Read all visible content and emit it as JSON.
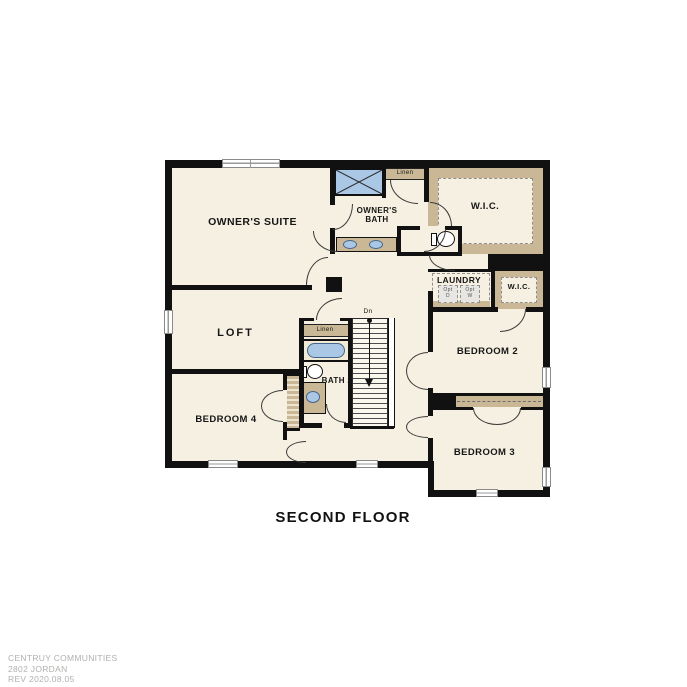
{
  "title": "SECOND FLOOR",
  "footer": {
    "line1": "CENTRUY COMMUNITIES",
    "line2": "2802 JORDAN",
    "line3": "REV 2020.08.05"
  },
  "rooms": {
    "owners_suite": "OWNER'S SUITE",
    "owners_bath": "OWNER'S BATH",
    "loft": "LOFT",
    "bedroom2": "BEDROOM 2",
    "bedroom3": "BEDROOM 3",
    "bedroom4": "BEDROOM 4",
    "bath2": "BATH 2",
    "laundry": "LAUNDRY",
    "wic_large": "W.I.C.",
    "wic_small": "W.I.C.",
    "linen_upper": "Linen",
    "linen_hall": "Linen",
    "opt_dryer": "Opt D",
    "opt_washer": "Opt W",
    "stairs_down": "Dn"
  },
  "fixtures": {
    "shower": "shower-icon",
    "tub": "bathtub-icon",
    "owners_toilet": "toilet-icon",
    "bath2_toilet": "toilet-icon",
    "owners_vanity": "double-sink-vanity-icon",
    "bath2_vanity": "sink-vanity-icon",
    "stairs": "staircase",
    "bedroom_closet": "closet-shelving"
  },
  "colors": {
    "floor": "#f5f0e1",
    "wall": "#111111",
    "carpet_tan": "#c9b795",
    "fixture_blue": "#aac8e6",
    "footer_text": "#b3b0ae"
  }
}
